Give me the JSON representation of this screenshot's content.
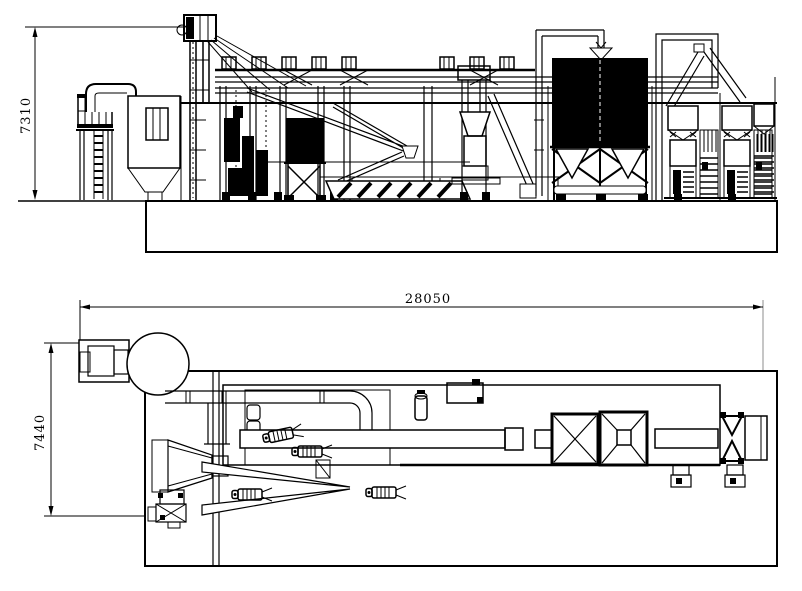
{
  "drawing": {
    "type": "engineering-drawing",
    "views": {
      "elevation": {
        "dimension_height": "7310"
      },
      "plan": {
        "dimension_length": "28050",
        "dimension_width": "7440"
      }
    },
    "colors": {
      "line": "#000000",
      "background": "#ffffff",
      "extension_line": "#8c8c8c"
    }
  }
}
